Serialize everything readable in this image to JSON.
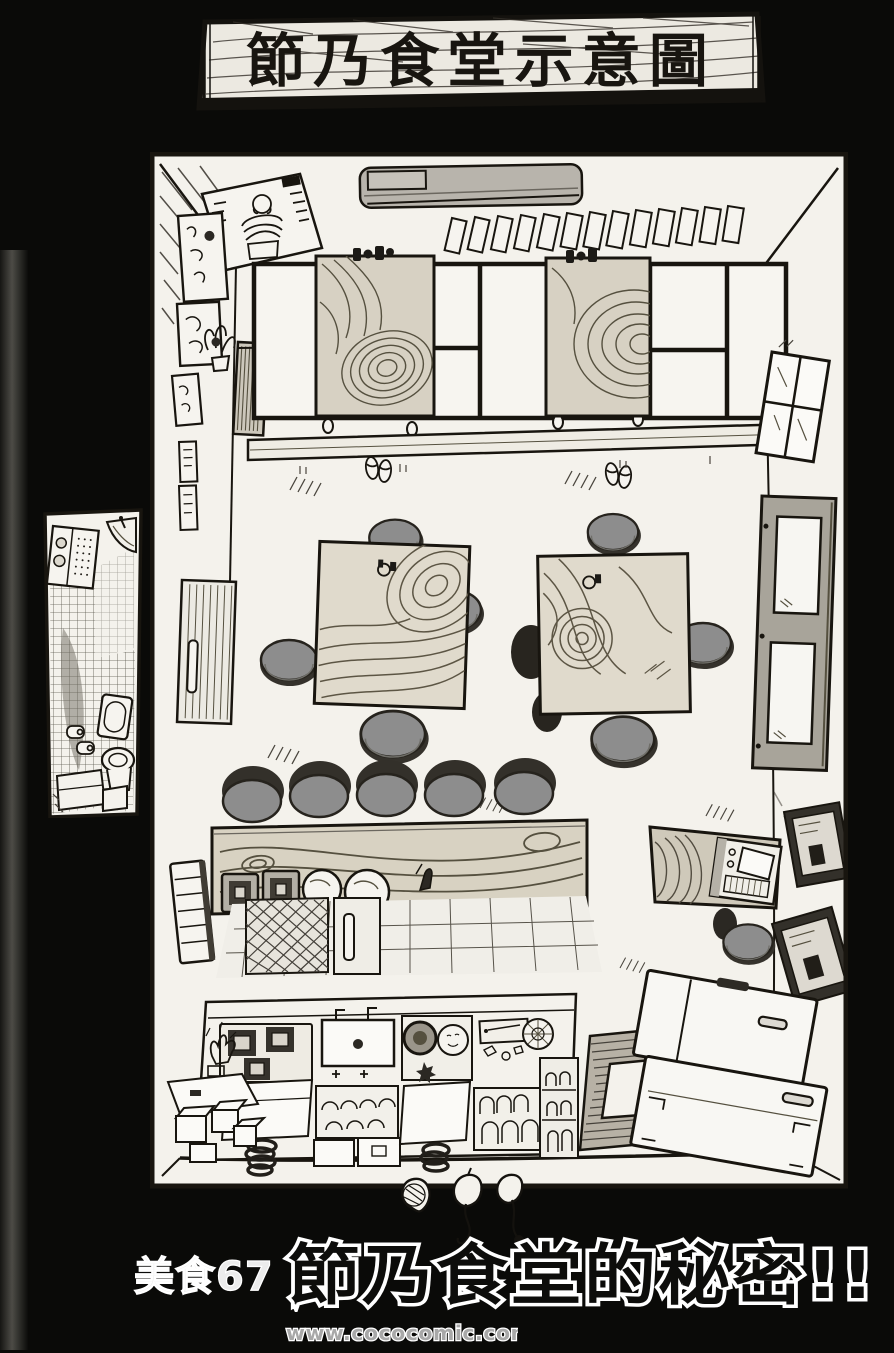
{
  "page": {
    "background_color": "#0a0a08",
    "paper_color": "#f4f2ec",
    "ink_color": "#18150f"
  },
  "banner": {
    "title": "節乃食堂示意圖"
  },
  "caption": {
    "chapter": "美食67",
    "title": "節乃食堂的秘密!!"
  },
  "watermark": {
    "text": "www.cococomic.com"
  },
  "colors": {
    "stool_gray": "#8d8d8d",
    "stool_shadow": "#35322c",
    "wood_light": "#d8d2c2",
    "wood_grain": "#55503f",
    "appliance_gray": "#b8b4ac",
    "door_gray": "#a8a49a",
    "mat_gray": "#b7b1a5"
  },
  "floorplan": {
    "objects": [
      "poster-muscle-man",
      "air-conditioner",
      "menu-plaques",
      "wall-art-frames",
      "potted-plant",
      "radiator",
      "tatami-platform",
      "low-table",
      "condiment-set",
      "entrance-sliding-door",
      "vent-window",
      "slippers",
      "dining-table",
      "round-stool",
      "counter",
      "gas-burner",
      "pot",
      "kitchen-tile-floor",
      "lattice-panel",
      "kitchen-workbench",
      "stove",
      "sink",
      "dish-crate",
      "cutting-board",
      "dish-shelf",
      "gas-hose-coil",
      "crates",
      "cactus",
      "floor-mat-with-hatch",
      "chest-freezer",
      "tv-set",
      "tv-stand",
      "window-4-pane",
      "back-door",
      "toilet",
      "corner-sink",
      "medicine-cabinet",
      "toilet-paper-rolls",
      "turnips"
    ]
  }
}
